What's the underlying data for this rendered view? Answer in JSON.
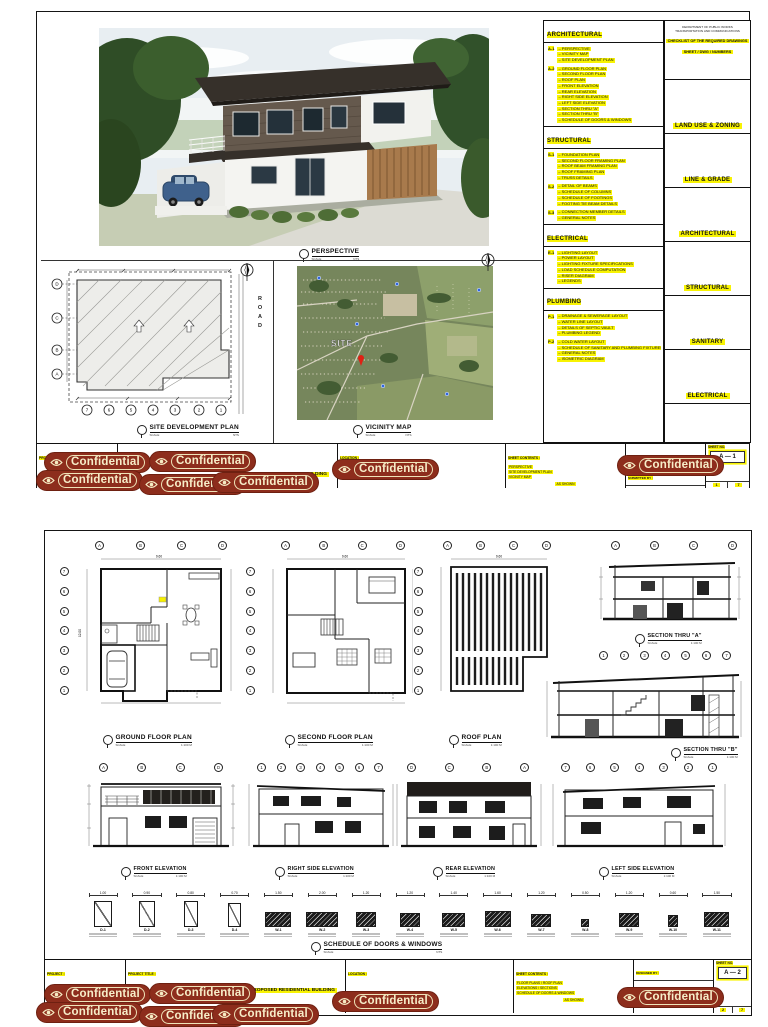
{
  "stamp": {
    "label": "Confidential"
  },
  "common": {
    "scale_word": "SCALE",
    "nts": "NTS",
    "metric": "1:100 M"
  },
  "tb": {
    "c1": "PROJECT :",
    "c2": "PROJECT TITLE :",
    "c3": "LOCATION :",
    "c4": "SHEET CONTENTS :",
    "sig_rows": [
      "DESIGNED BY :",
      "SUBMITTED BY :",
      "RECOMMENDED BY :",
      "APPROVED BY :",
      "DATE :"
    ],
    "sheet_label": "SHEET NO."
  },
  "page1": {
    "perspective": {
      "title": "PERSPECTIVE"
    },
    "site_plan": {
      "title": "SITE DEVELOPMENT PLAN",
      "road": "ROAD",
      "row_bubbles": [
        "D",
        "C",
        "B",
        "A"
      ],
      "col_bubbles": [
        "7",
        "6",
        "5",
        "4",
        "3",
        "2",
        "1"
      ]
    },
    "vicinity": {
      "title": "VICINITY MAP",
      "site": "SITE"
    },
    "notes": {
      "architectural": {
        "title": "ARCHITECTURAL",
        "groups": [
          {
            "code": "A-1",
            "items": [
              "PERSPECTIVE",
              "VICINITY MAP",
              "SITE DEVELOPMENT PLAN"
            ]
          },
          {
            "code": "A-2",
            "items": [
              "GROUND FLOOR PLAN",
              "SECOND FLOOR PLAN",
              "ROOF PLAN",
              "FRONT ELEVATION",
              "REAR ELEVATION",
              "RIGHT SIDE ELEVATION",
              "LEFT SIDE ELEVATION",
              "SECTION THRU \"A\"",
              "SECTION THRU \"B\"",
              "SCHEDULE OF DOORS & WINDOWS"
            ]
          }
        ]
      },
      "structural": {
        "title": "STRUCTURAL",
        "groups": [
          {
            "code": "S-1",
            "items": [
              "FOUNDATION PLAN",
              "SECOND FLOOR FRAMING PLAN",
              "ROOF BEAM FRAMING PLAN",
              "ROOF FRAMING PLAN",
              "TRUSS DETAILS"
            ]
          },
          {
            "code": "S-2",
            "items": [
              "DETAIL OF BEAMS",
              "SCHEDULE OF COLUMNS",
              "SCHEDULE OF FOOTINGS",
              "FOOTING TIE BEAM DETAILS"
            ]
          },
          {
            "code": "S-3",
            "items": [
              "CONNECTION MEMBER DETAILS",
              "GENERAL NOTES"
            ]
          }
        ]
      },
      "electrical": {
        "title": "ELECTRICAL",
        "groups": [
          {
            "code": "E-1",
            "items": [
              "LIGHTING LAYOUT",
              "POWER LAYOUT",
              "LIGHTING FIXTURE SPECIFICATIONS",
              "LOAD SCHEDULE COMPUTATION",
              "RISER DIAGRAM",
              "LEGENDS"
            ]
          }
        ]
      },
      "plumbing": {
        "title": "PLUMBING",
        "groups": [
          {
            "code": "P-1",
            "items": [
              "DRAINAGE & SEWERAGE LAYOUT",
              "WATER LINE LAYOUT",
              "DETAILS OF SEPTIC VAULT",
              "PLUMBING LEGEND"
            ]
          },
          {
            "code": "P-2",
            "items": [
              "COLD WATER LAYOUT",
              "SCHEDULE OF SANITARY AND PLUMBING FIXTURES",
              "GENERAL NOTES",
              "ISOMETRIC DIAGRAM"
            ]
          }
        ]
      }
    },
    "checklist": {
      "dept1": "DEPARTMENT OF PUBLIC WORKS",
      "dept2": "TRANSPORTATION AND COMMUNICATIONS",
      "header1": "CHECKLIST OF THE REQUIRED DRAWINGS",
      "header2": "SHEET / DWG / NUMBERS",
      "rows": [
        "LAND USE & ZONING",
        "LINE & GRADE",
        "ARCHITECTURAL",
        "STRUCTURAL",
        "SANITARY",
        "ELECTRICAL"
      ]
    },
    "titleblock": {
      "project": "PROPOSED RESIDENTIAL BUILDING",
      "contents": [
        "PERSPECTIVE",
        "SITE DEVELOPMENT PLAN",
        "VICINITY MAP"
      ],
      "scale_note": "AS SHOWN",
      "sheet_no": "A — 1",
      "page": "1",
      "total": "7"
    }
  },
  "page2": {
    "bubbles": {
      "ad": [
        "A",
        "B",
        "C",
        "D"
      ],
      "da": [
        "D",
        "C",
        "B",
        "A"
      ],
      "n17": [
        "1",
        "2",
        "3",
        "4",
        "5",
        "6",
        "7"
      ],
      "n71": [
        "7",
        "6",
        "5",
        "4",
        "3",
        "2",
        "1"
      ]
    },
    "plans": {
      "dim_w": "9.60",
      "dim_h": "12.00",
      "ground": {
        "title": "GROUND FLOOR PLAN"
      },
      "second": {
        "title": "SECOND FLOOR PLAN"
      },
      "roof": {
        "title": "ROOF PLAN"
      }
    },
    "sections": {
      "a": {
        "title": "SECTION THRU \"A\""
      },
      "b": {
        "title": "SECTION THRU \"B\""
      }
    },
    "elevations": {
      "front": {
        "title": "FRONT ELEVATION"
      },
      "right": {
        "title": "RIGHT SIDE ELEVATION"
      },
      "rear": {
        "title": "REAR ELEVATION"
      },
      "left": {
        "title": "LEFT SIDE ELEVATION"
      }
    },
    "schedule": {
      "title": "SCHEDULE OF DOORS & WINDOWS",
      "items": [
        {
          "code": "D-1",
          "dim": "1.00",
          "kind": "door",
          "w": 18,
          "h": 26
        },
        {
          "code": "D-2",
          "dim": "0.90",
          "kind": "door",
          "w": 16,
          "h": 26
        },
        {
          "code": "D-3",
          "dim": "0.80",
          "kind": "door",
          "w": 14,
          "h": 26
        },
        {
          "code": "D-4",
          "dim": "0.70",
          "kind": "door",
          "w": 13,
          "h": 24
        },
        {
          "code": "W-1",
          "dim": "1.50",
          "kind": "window",
          "w": 26,
          "h": 15
        },
        {
          "code": "W-2",
          "dim": "2.00",
          "kind": "window",
          "w": 32,
          "h": 15
        },
        {
          "code": "W-3",
          "dim": "1.20",
          "kind": "window",
          "w": 20,
          "h": 15
        },
        {
          "code": "W-4",
          "dim": "1.20",
          "kind": "window",
          "w": 20,
          "h": 14
        },
        {
          "code": "W-5",
          "dim": "1.40",
          "kind": "window",
          "w": 23,
          "h": 14
        },
        {
          "code": "W-6",
          "dim": "1.60",
          "kind": "window",
          "w": 26,
          "h": 16
        },
        {
          "code": "W-7",
          "dim": "1.20",
          "kind": "window",
          "w": 20,
          "h": 13
        },
        {
          "code": "W-8",
          "dim": "0.50",
          "kind": "window-small",
          "w": 8,
          "h": 8
        },
        {
          "code": "W-9",
          "dim": "1.20",
          "kind": "window",
          "w": 20,
          "h": 14
        },
        {
          "code": "W-10",
          "dim": "0.60",
          "kind": "window",
          "w": 10,
          "h": 12
        },
        {
          "code": "W-11",
          "dim": "1.50",
          "kind": "window",
          "w": 25,
          "h": 15
        }
      ]
    },
    "titleblock": {
      "project": "PROPOSED RESIDENTIAL BUILDING",
      "contents": [
        "FLOOR PLANS / ROOF PLAN",
        "ELEVATIONS / SECTIONS",
        "SCHEDULE OF DOORS & WINDOWS"
      ],
      "scale_note": "AS SHOWN",
      "sheet_no": "A — 2",
      "page": "2",
      "total": "7"
    }
  }
}
